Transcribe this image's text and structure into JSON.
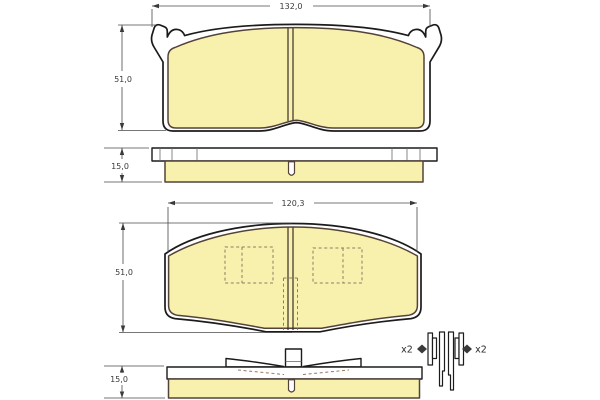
{
  "colors": {
    "background": "#FFFFFF",
    "friction_fill": "#F8F1AD",
    "plate_fill": "#FFFFFF",
    "plate_outline": "#1B1B1B",
    "friction_outline": "#54423A",
    "dimension_color": "#4A4A4A",
    "hidden_line_color": "#8F7A62"
  },
  "top_view": {
    "width_label": "132,0",
    "height_label": "51,0",
    "thickness_label": "15,0"
  },
  "bottom_view": {
    "width_label": "120,3",
    "height_label": "51,0",
    "thickness_label": "15,0"
  },
  "accessories": {
    "left_quantity_label": "x2",
    "right_quantity_label": "x2"
  }
}
